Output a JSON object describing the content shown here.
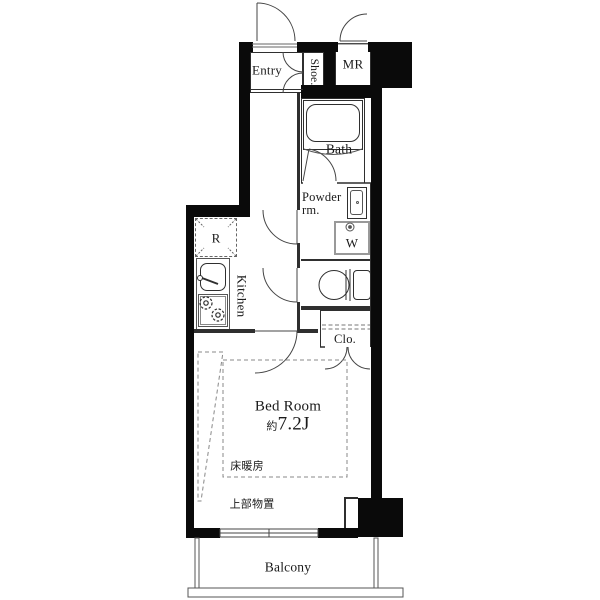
{
  "plan": {
    "rooms": {
      "entry": {
        "label": "Entry"
      },
      "shoe": {
        "label": "Shoe."
      },
      "meter": {
        "label": "MR"
      },
      "bath": {
        "label": "Bath"
      },
      "powder": {
        "label_line1": "Powder",
        "label_line2": "rm."
      },
      "washer": {
        "label": "W"
      },
      "fridge": {
        "label": "R"
      },
      "kitchen": {
        "label": "Kitchen"
      },
      "closet": {
        "label": "Clo."
      },
      "bedroom": {
        "label": "Bed Room",
        "size_prefix": "約",
        "size": "7.2J"
      },
      "balcony": {
        "label": "Balcony"
      }
    },
    "annotations": {
      "floor_heating": "床暖房",
      "overhead_storage": "上部物置"
    },
    "colors": {
      "wall": "#0a0a0a",
      "line": "#2f2f2f",
      "background": "#ffffff"
    }
  }
}
